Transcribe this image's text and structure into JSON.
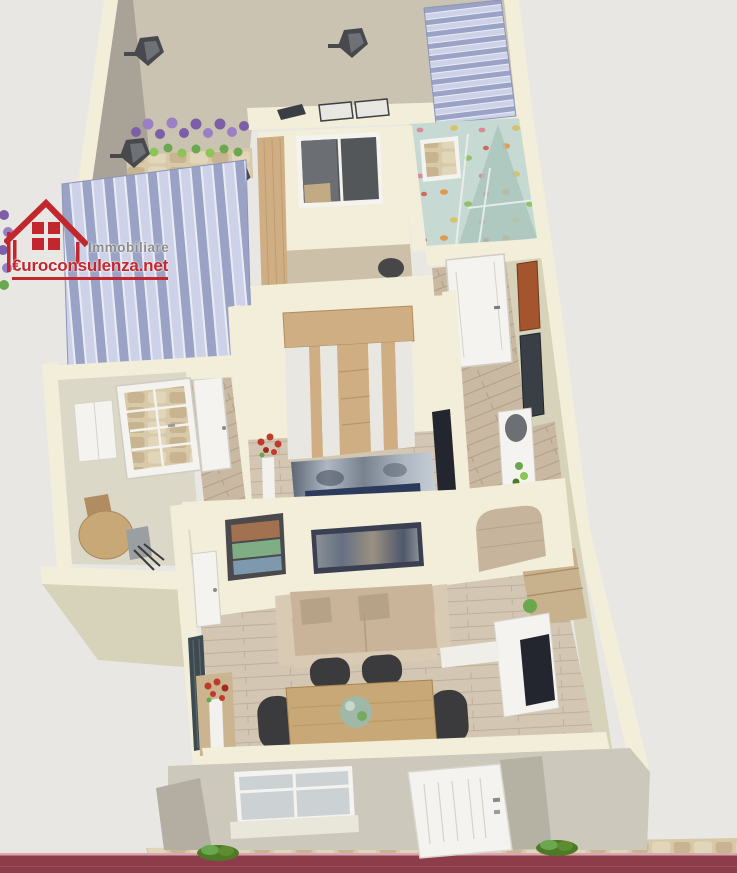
{
  "watermark": {
    "line1": "Immobiliare",
    "line2": "€uroconsulenza.net"
  },
  "scene": {
    "type": "3d-floor-plan-render",
    "areas": [
      "terrace",
      "small-bedroom",
      "bathroom",
      "entrance-hall",
      "master-bedroom",
      "hallway",
      "kitchen-dining",
      "living-room",
      "front-facade",
      "street"
    ],
    "objects": [
      "wall-lantern-lamps",
      "lavender-planter",
      "striped-awnings",
      "outdoor-bench",
      "wardrobe",
      "double-bed",
      "flower-vases",
      "console-table",
      "round-table",
      "dining-table",
      "dining-chairs",
      "sofa",
      "panoramic-picture",
      "triple-picture-frame",
      "media-wall",
      "tv",
      "french-glass-door",
      "entrance-door",
      "front-door",
      "front-window",
      "stone-path",
      "garden-bushes"
    ]
  },
  "colors": {
    "background": "#e8e7e4",
    "wall_top": "#f2eed9",
    "wall_side": "#d7d3ba",
    "wall_side_dark": "#c9c5aa",
    "wall_face_taupe": "#a9a296",
    "terrace_floor": "#cbc3b1",
    "stone_base": "#d8c9a8",
    "stone_dark": "#c6b18c",
    "stone_light": "#e2d6ba",
    "awning_dark": "#9aa3c5",
    "awning_light": "#cdd2e8",
    "awning_gap": "#e9ebf5",
    "bath_floor": "#c6dad3",
    "bath_shade": "#a9c4bc",
    "kitchen_floor": "#dbd8c8",
    "plank_light": "#d3c7b4",
    "plank_line": "#b9a992",
    "plank_mid": "#c9b8a2",
    "plank_mid_line": "#ab9880",
    "wood_furniture": "#cfae83",
    "wood_grain": "#b8956a",
    "table_wood": "#c9a877",
    "white_panel": "#e9e7e1",
    "door_white": "#f4f3ef",
    "door_line": "#d5d2c8",
    "glass": "#ccd2d4",
    "dark_interior": "#54575a",
    "sofa_base": "#c9b49a",
    "sofa_pillow": "#b5a287",
    "sofa_arm": "#d9cab3",
    "chair_dark": "#3b3b3d",
    "bed_navy": "#2c3a5c",
    "bed_m1": "#5d6775",
    "bed_m2": "#aeb7c2",
    "bed_m3": "#78828f",
    "bed_m4": "#c6cdd6",
    "city_1": "#8a8f96",
    "city_2": "#667082",
    "city_3": "#9a9082",
    "city_4": "#4e576b",
    "flower_red": "#c0392b",
    "foliage": "#6aa84f",
    "foliage_dark": "#4e7a28",
    "lavender": "#7d5fa8",
    "lavender_light": "#9a7fc4",
    "lamp_dark": "#47494d",
    "lamp_face": "#6e7277",
    "tv_dark": "#23262e",
    "stucco_front": "#ccc8bb",
    "stucco_side": "#b3aea1",
    "road": "#8d3c4a",
    "road_line": "#d9a7b0",
    "photo_town": "#a2714f",
    "photo_green": "#7fae84",
    "photo_water": "#7e99ad",
    "pic_orange": "#a4552e",
    "pic_dark": "#3a3f45",
    "shelf_wood": "#c8b18d",
    "radiator": "#3d4a4f",
    "logo_red": "#c1272d",
    "logo_gray": "#8c8c8c"
  }
}
